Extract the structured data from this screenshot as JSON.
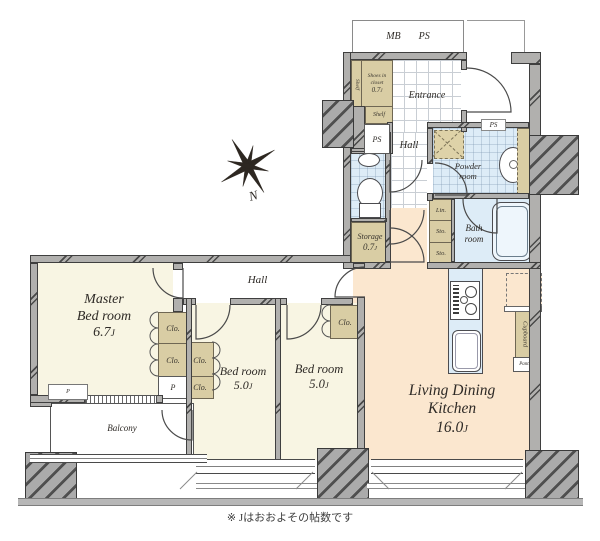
{
  "palette": {
    "wall": "#b1b0ae",
    "wall_line": "#3f3f3f",
    "room_cream": "#f8f5e3",
    "room_peach": "#fbe7cf",
    "wet_blue": "#ddecf7",
    "closet_tan": "#d9cda4",
    "ink": "#2e2a26"
  },
  "caption": "※ Jはおおよその帖数です",
  "compass": {
    "label": "N"
  },
  "top_labels": {
    "mb": "MB",
    "ps": "PS"
  },
  "rooms": {
    "entrance": {
      "name": "Entrance"
    },
    "hall_upper": {
      "name": "Hall"
    },
    "hall_lower": {
      "name": "Hall"
    },
    "powder": {
      "line1": "Powder",
      "line2": "room"
    },
    "bath": {
      "line1": "Bath",
      "line2": "room"
    },
    "master": {
      "line1": "Master",
      "line2": "Bed room",
      "size": "6.7",
      "unit": "J"
    },
    "bedroom1": {
      "name": "Bed room",
      "size": "5.0",
      "unit": "J"
    },
    "bedroom2": {
      "name": "Bed room",
      "size": "5.0",
      "unit": "J"
    },
    "ldk": {
      "line1": "Living Dining",
      "line2": "Kitchen",
      "size": "16.0",
      "unit": "J"
    },
    "balcony": {
      "name": "Balcony"
    },
    "storage": {
      "name": "Storage",
      "size": "0.7",
      "unit": "J"
    },
    "shoes_closet": {
      "line1": "Shoes in",
      "line2": "closet",
      "size": "0.7",
      "unit": "J"
    }
  },
  "small_labels": {
    "shelf": "Shelf",
    "ps": "PS",
    "lin": "Lin.",
    "sto": "Sto.",
    "clo": "Clo.",
    "p": "P",
    "cupboard": "Cupboard",
    "pantry": "Pantry"
  }
}
